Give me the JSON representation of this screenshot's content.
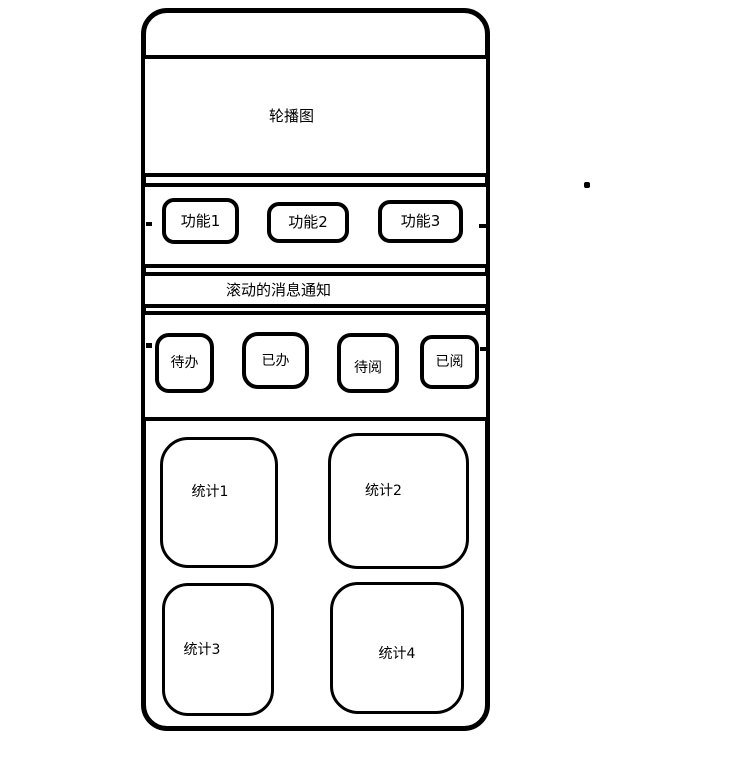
{
  "canvas": {
    "background": "#ffffff",
    "stroke_color": "#000000"
  },
  "phone": {
    "carousel": {
      "label": "轮播图"
    },
    "features": [
      {
        "label": "功能1"
      },
      {
        "label": "功能2"
      },
      {
        "label": "功能3"
      }
    ],
    "notice": {
      "label": "滚动的消息通知"
    },
    "actions": [
      {
        "label": "待办"
      },
      {
        "label": "已办"
      },
      {
        "label": "待阅"
      },
      {
        "label": "已阅"
      }
    ],
    "stats": [
      {
        "label": "统计1"
      },
      {
        "label": "统计2"
      },
      {
        "label": "统计3"
      },
      {
        "label": "统计4"
      }
    ]
  }
}
